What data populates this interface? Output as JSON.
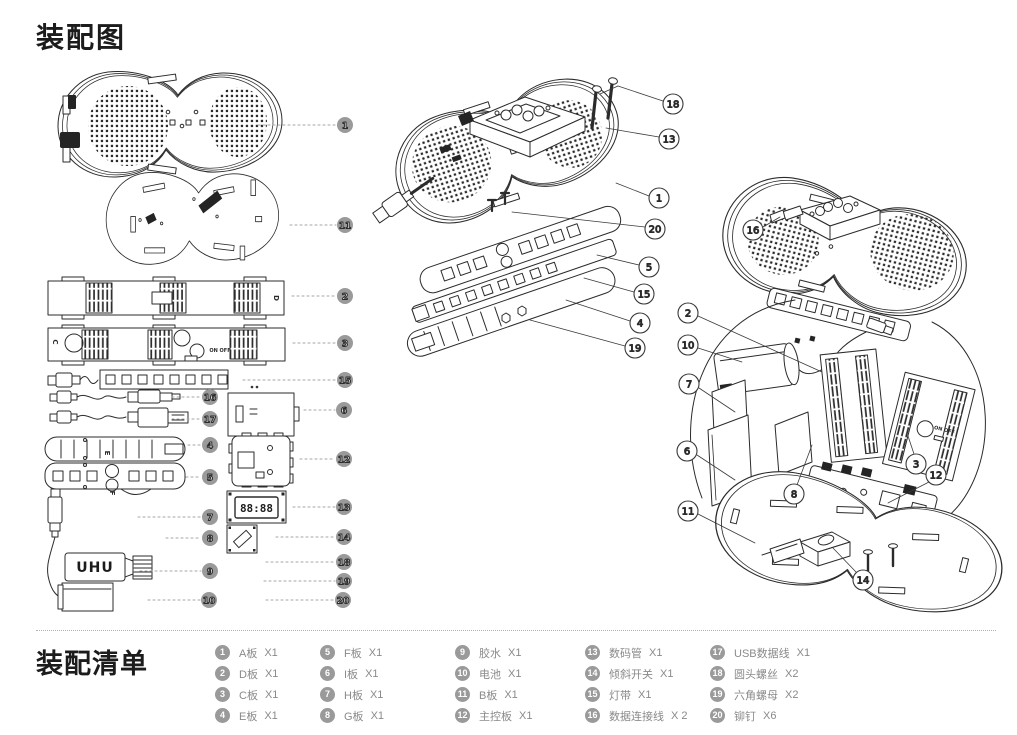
{
  "header": {
    "title": "装配图"
  },
  "footer": {
    "title": "装配清单",
    "items": [
      {
        "n": "1",
        "label": "A板",
        "qty": "X1"
      },
      {
        "n": "2",
        "label": "D板",
        "qty": "X1"
      },
      {
        "n": "3",
        "label": "C板",
        "qty": "X1"
      },
      {
        "n": "4",
        "label": "E板",
        "qty": "X1"
      },
      {
        "n": "5",
        "label": "F板",
        "qty": "X1"
      },
      {
        "n": "6",
        "label": "I板",
        "qty": "X1"
      },
      {
        "n": "7",
        "label": "H板",
        "qty": "X1"
      },
      {
        "n": "8",
        "label": "G板",
        "qty": "X1"
      },
      {
        "n": "9",
        "label": "胶水",
        "qty": "X1"
      },
      {
        "n": "10",
        "label": "电池",
        "qty": "X1"
      },
      {
        "n": "11",
        "label": "B板",
        "qty": "X1"
      },
      {
        "n": "12",
        "label": "主控板",
        "qty": "X1"
      },
      {
        "n": "13",
        "label": "数码管",
        "qty": "X1"
      },
      {
        "n": "14",
        "label": "倾斜开关",
        "qty": "X1"
      },
      {
        "n": "15",
        "label": "灯带",
        "qty": "X1"
      },
      {
        "n": "16",
        "label": "数据连接线",
        "qty": "X 2"
      },
      {
        "n": "17",
        "label": "USB数据线",
        "qty": "X1"
      },
      {
        "n": "18",
        "label": "圆头螺丝",
        "qty": "X2"
      },
      {
        "n": "19",
        "label": "六角螺母",
        "qty": "X2"
      },
      {
        "n": "20",
        "label": "铆钉",
        "qty": "X6"
      }
    ]
  },
  "diagram": {
    "left_callouts": [
      "1",
      "11",
      "2",
      "3",
      "15",
      "16",
      "6",
      "17",
      "4",
      "12",
      "5",
      "13",
      "7",
      "14",
      "8",
      "18",
      "9",
      "19",
      "10",
      "20"
    ],
    "middle_callouts": [
      "18",
      "13",
      "1",
      "20",
      "5",
      "15",
      "4",
      "19"
    ],
    "right_callouts": [
      "16",
      "2",
      "10",
      "7",
      "6",
      "8",
      "3",
      "12",
      "11",
      "14"
    ],
    "labels": {
      "display_digits": "88:88",
      "glue_brand": "UHU",
      "on_off": "ON OFF",
      "plate_c": "C",
      "plate_d": "D",
      "plate_e": "E",
      "plate_f": "F",
      "plate_g": "G",
      "plate_h": "H"
    }
  }
}
